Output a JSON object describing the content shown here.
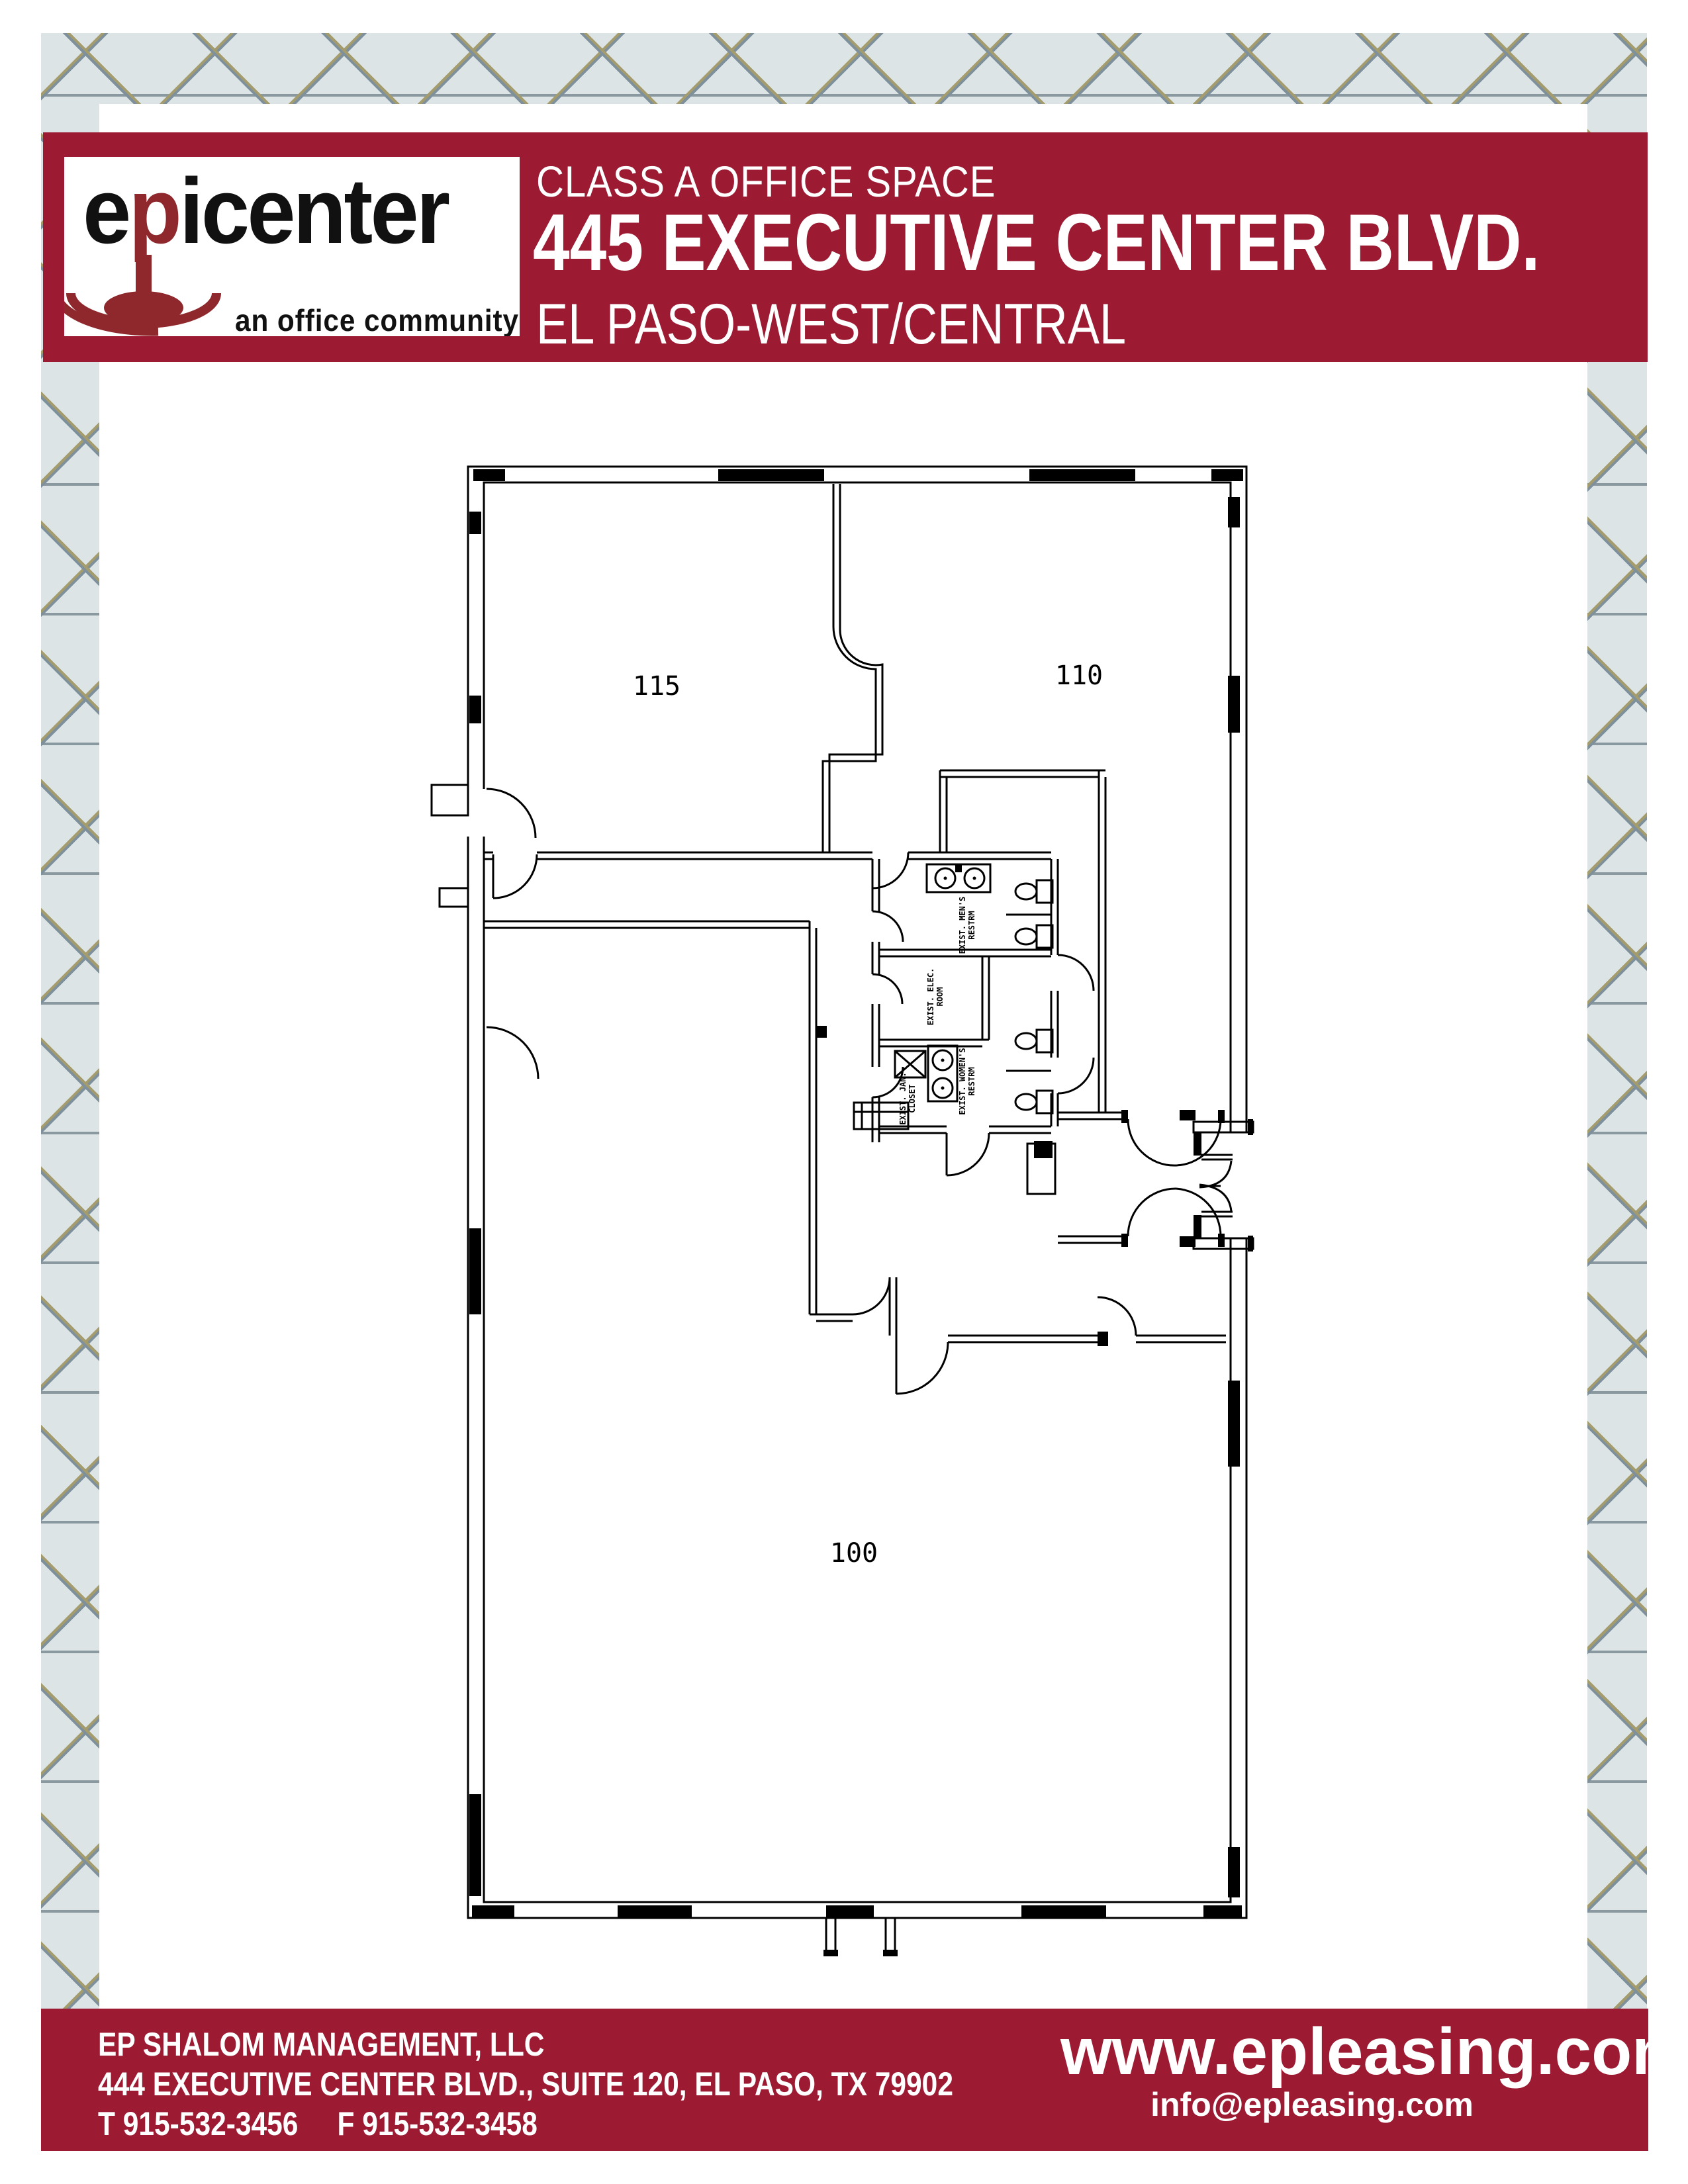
{
  "theme": {
    "maroon": "#9C1B33",
    "logo_red": "#8E282C",
    "pattern_bg": "#DCE4E6",
    "pattern_line_olive": "#A49C6C",
    "pattern_line_gray": "#7E909B",
    "plan_ink": "#000000"
  },
  "logo": {
    "brand_e": "e",
    "brand_p": "p",
    "brand_i": "i",
    "brand_rest": "center",
    "tagline": "an office community"
  },
  "banner": {
    "line1": "CLASS A OFFICE SPACE",
    "line2": "445 EXECUTIVE CENTER BLVD.",
    "line3": "EL PASO-WEST/CENTRAL"
  },
  "floor_plan": {
    "rooms": {
      "r115": "115",
      "r110": "110",
      "r100": "100"
    },
    "core_labels": {
      "mens": {
        "line1": "EXIST. MEN'S",
        "line2": "RESTRM"
      },
      "elec": {
        "line1": "EXIST. ELEC.",
        "line2": "ROOM"
      },
      "jan": {
        "line1": "EXIST. JAN.",
        "line2": "CLOSET"
      },
      "womens": {
        "line1": "EXIST. WOMEN'S",
        "line2": "RESTRM"
      }
    }
  },
  "footer": {
    "company": "EP SHALOM MANAGEMENT, LLC",
    "address": "444 EXECUTIVE CENTER BLVD., SUITE 120, EL PASO, TX 79902",
    "phones": "T 915-532-3456     F 915-532-3458",
    "website": "www.epleasing.com",
    "email": "info@epleasing.com"
  }
}
